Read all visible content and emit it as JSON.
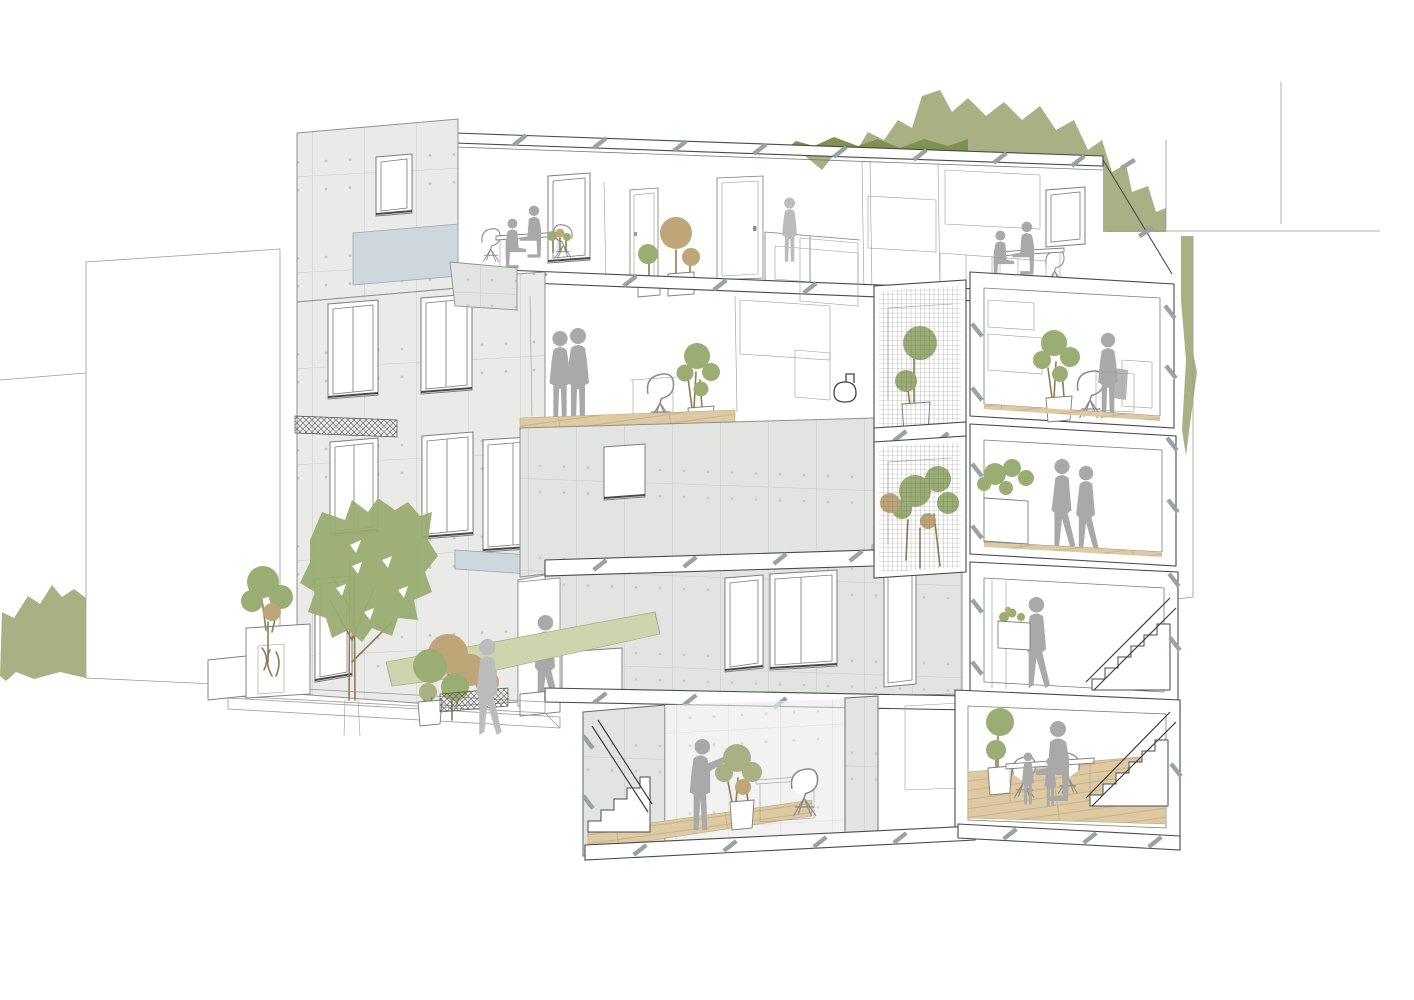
{
  "meta": {
    "type": "architectural-axonometric-section",
    "subject": "Cutaway perspective of a five-level residential infill building with concrete panel facade, stacked mesh-screened planted loggias, roof garden backdrop, street landscaping and occupant silhouettes",
    "floors_visible": 5,
    "figures_total": 17
  },
  "colors": {
    "background": "#ffffff",
    "line_light": "#9a9a9a",
    "line_mid": "#7c7c7c",
    "line_dark": "#4a4a4a",
    "concrete_panel": "#eaebe9",
    "concrete_side": "#e2e4e2",
    "concrete_back": "#eeefed",
    "panel_joint": "#c8c9c7",
    "panel_dot": "#c4c6c4",
    "spandrel_blue": "#cdd7dd",
    "wood_floor": "#ddc9a2",
    "wood_line": "#c3ab80",
    "foliage_olive": "#a9b184",
    "foliage_dark": "#7d9150",
    "tree_green": "#9aad72",
    "foliage_pale": "#ccd5ae",
    "foliage_tan": "#bfa678",
    "trunk_brown": "#8f7c57",
    "figure_gray": "#a9a9a9",
    "figure_light": "#bcbcbc",
    "mesh_line": "#5f5f5f",
    "tick": "#9aa3a3"
  },
  "levels": [
    {
      "name": "attic",
      "occupants": [
        "couple-at-window-table",
        "resident-by-partition",
        "couple-at-balcony-table"
      ],
      "items": [
        "dormer-window",
        "interior-doors",
        "potted-trees",
        "balcony-railing",
        "roof-slab"
      ]
    },
    {
      "name": "third-floor",
      "occupants": [
        "standing-couple",
        "resident-with-bag"
      ],
      "items": [
        "houseplant",
        "shell-chair",
        "bathroom-with-toilet",
        "mesh-screen-topiary"
      ]
    },
    {
      "name": "second-floor",
      "occupants": [
        "walking-couple"
      ],
      "items": [
        "cantilevered-concrete-volume",
        "planter-box",
        "mesh-screen-tree"
      ]
    },
    {
      "name": "ground-floor",
      "occupants": [
        "resident-entering",
        "pedestrian",
        "resident-on-stair"
      ],
      "items": [
        "entry-steps",
        "glazed-openings",
        "tall-door",
        "railing-planter"
      ]
    },
    {
      "name": "basement",
      "occupants": [
        "resident-pointing",
        "parent-with-two-children"
      ],
      "items": [
        "open-stair",
        "potted-plant",
        "dining-table",
        "timber-floor",
        "switchback-stair"
      ]
    }
  ],
  "landscape": {
    "street": [
      "large-street-tree",
      "small-tan-tree",
      "hedge-planter",
      "planter-boxes",
      "potted-shrub",
      "hatched-ramp-edge"
    ],
    "backdrop": [
      "roof-garden-canopy",
      "left-shrub-mass",
      "neighbour-building-left",
      "neighbour-building-right",
      "foliage-sliver-right"
    ]
  }
}
